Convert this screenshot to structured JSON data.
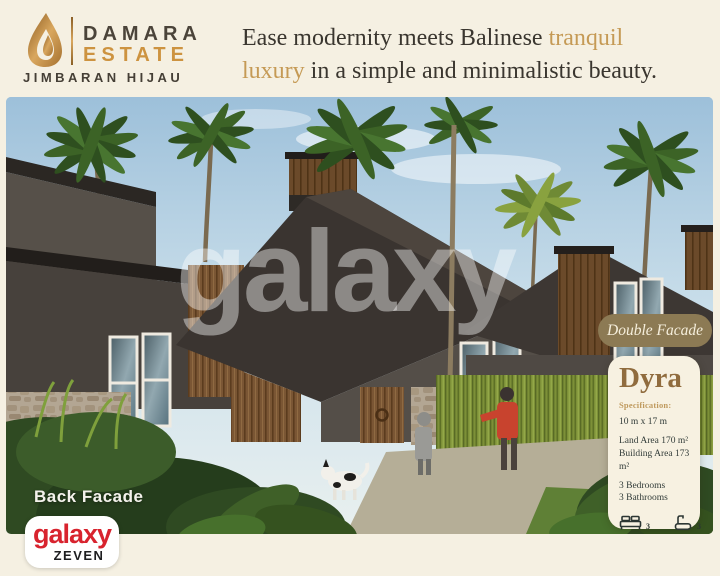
{
  "colors": {
    "page_bg": "#f5f0e2",
    "tagline_gold": "#c59a55",
    "estate_gold": "#cd9340",
    "text_dark": "#3a362f",
    "badge_bg": "#8c7a54",
    "badge_text": "#f5eedb",
    "card_bg": "#f7f1e1",
    "card_title": "#906c3e",
    "spec_label": "#bf9a5e",
    "spec_text": "#333d3a",
    "brand_red": "#d8232e"
  },
  "header": {
    "logo": {
      "name_line1": "DAMARA",
      "name_line2": "ESTATE",
      "subtitle": "JIMBARAN HIJAU"
    },
    "tagline": {
      "part1": "Ease modernity meets Balinese ",
      "highlight1": "tranquil",
      "highlight2": "luxury",
      "part2": " in a simple and minimalistic beauty."
    }
  },
  "hero": {
    "watermark": "galaxy",
    "facade_label": "Back Facade",
    "badge_label": "Double Facade"
  },
  "spec_card": {
    "title": "Dyra",
    "section_label": "Specification:",
    "dimensions": "10 m x 17 m",
    "land_area": "Land Area 170 m²",
    "building_area": "Building Area 173 m²",
    "bedrooms": "3 Bedrooms",
    "bathrooms": "3 Bathrooms",
    "bed_count": "3",
    "bath_count": "3"
  },
  "brand_footer": {
    "brand": "galaxy",
    "sub_brand": "ZEVEN"
  }
}
